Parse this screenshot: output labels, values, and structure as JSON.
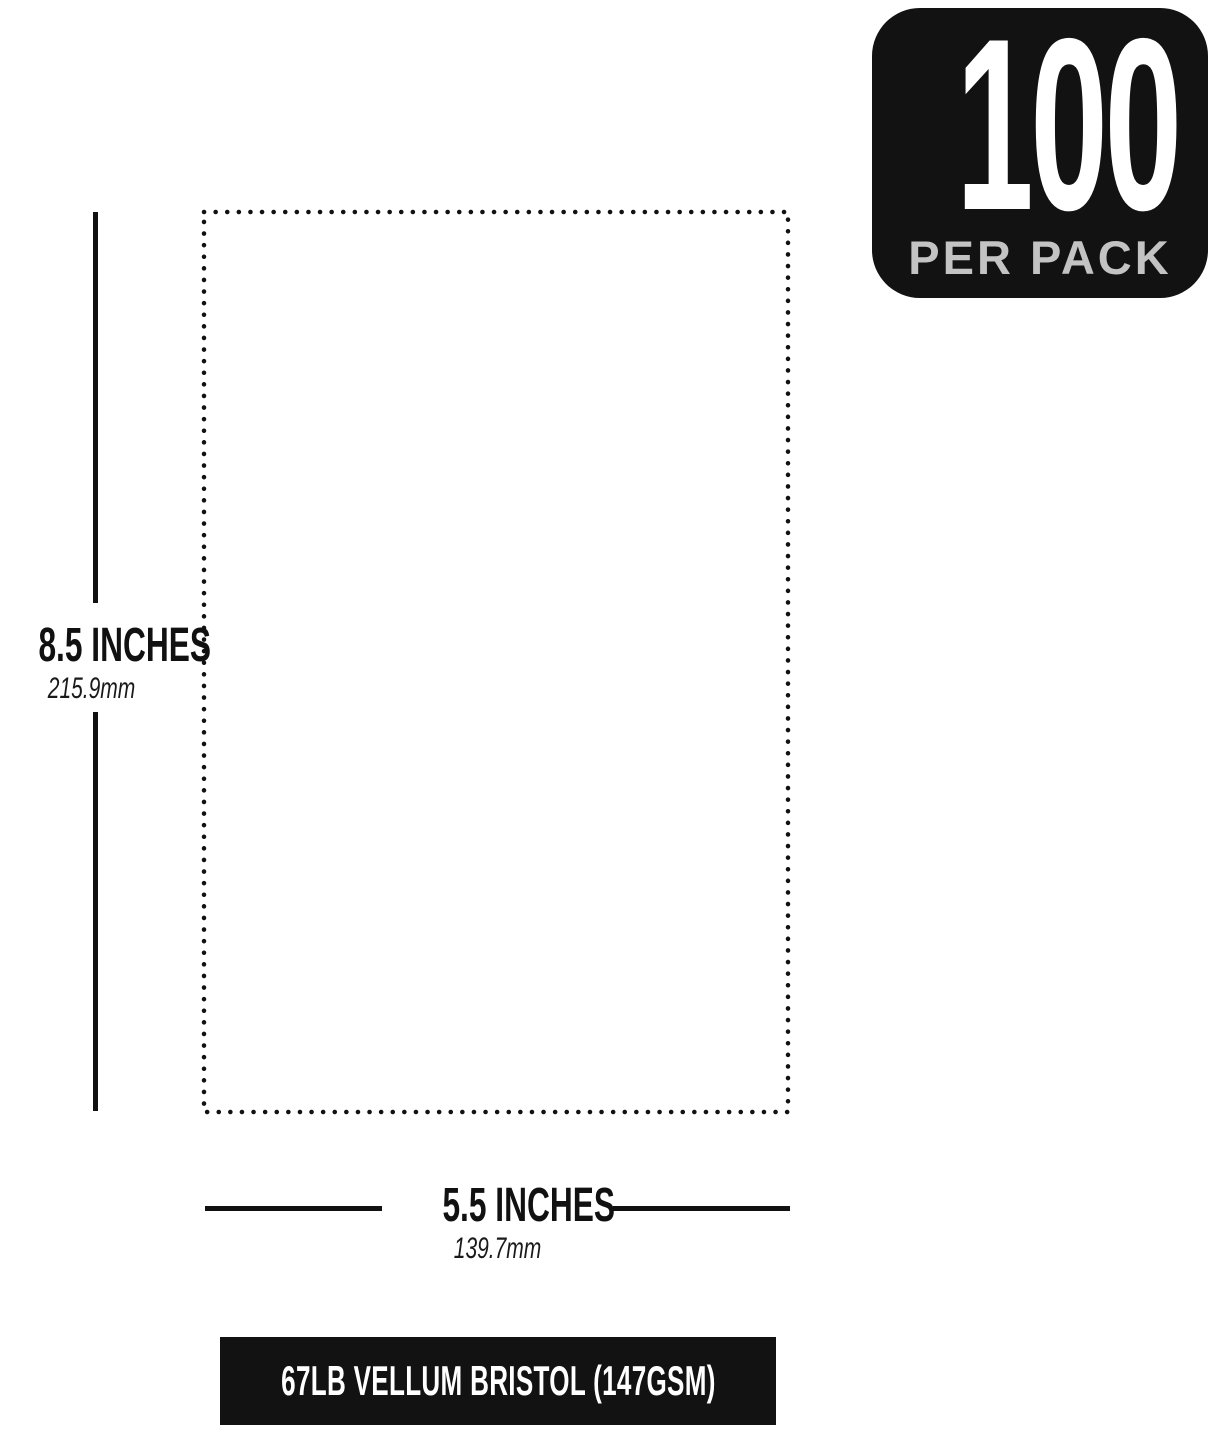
{
  "badge": {
    "count": "100",
    "label": "PER PACK",
    "background_color": "#121212",
    "count_color": "#ffffff",
    "label_color": "#c3c3c3"
  },
  "dimensions": {
    "height": {
      "inches": "8.5 INCHES",
      "mm": "215.9mm"
    },
    "width": {
      "inches": "5.5 INCHES",
      "mm": "139.7mm"
    }
  },
  "footer": {
    "label": "67LB VELLUM BRISTOL (147GSM)",
    "background_color": "#121212",
    "text_color": "#ffffff"
  },
  "colors": {
    "line": "#111111",
    "background": "#ffffff"
  }
}
